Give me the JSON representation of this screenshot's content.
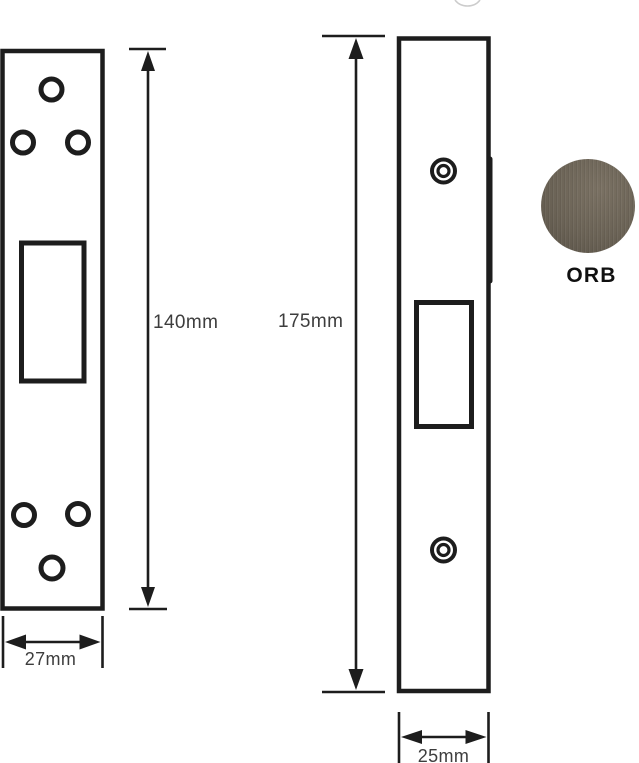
{
  "colors": {
    "line": "#1d1d1d",
    "dim-text": "#3d3d3d",
    "label-text": "#101010",
    "swatch": "#6b6356",
    "swatch-light": "#7a7163",
    "swatch-dark": "#5a5348"
  },
  "diagram": {
    "left_plate": {
      "height_label": "140mm",
      "width_label": "27mm"
    },
    "right_plate": {
      "height_label": "175mm",
      "width_label": "25mm"
    },
    "finish": {
      "label": "ORB"
    }
  }
}
